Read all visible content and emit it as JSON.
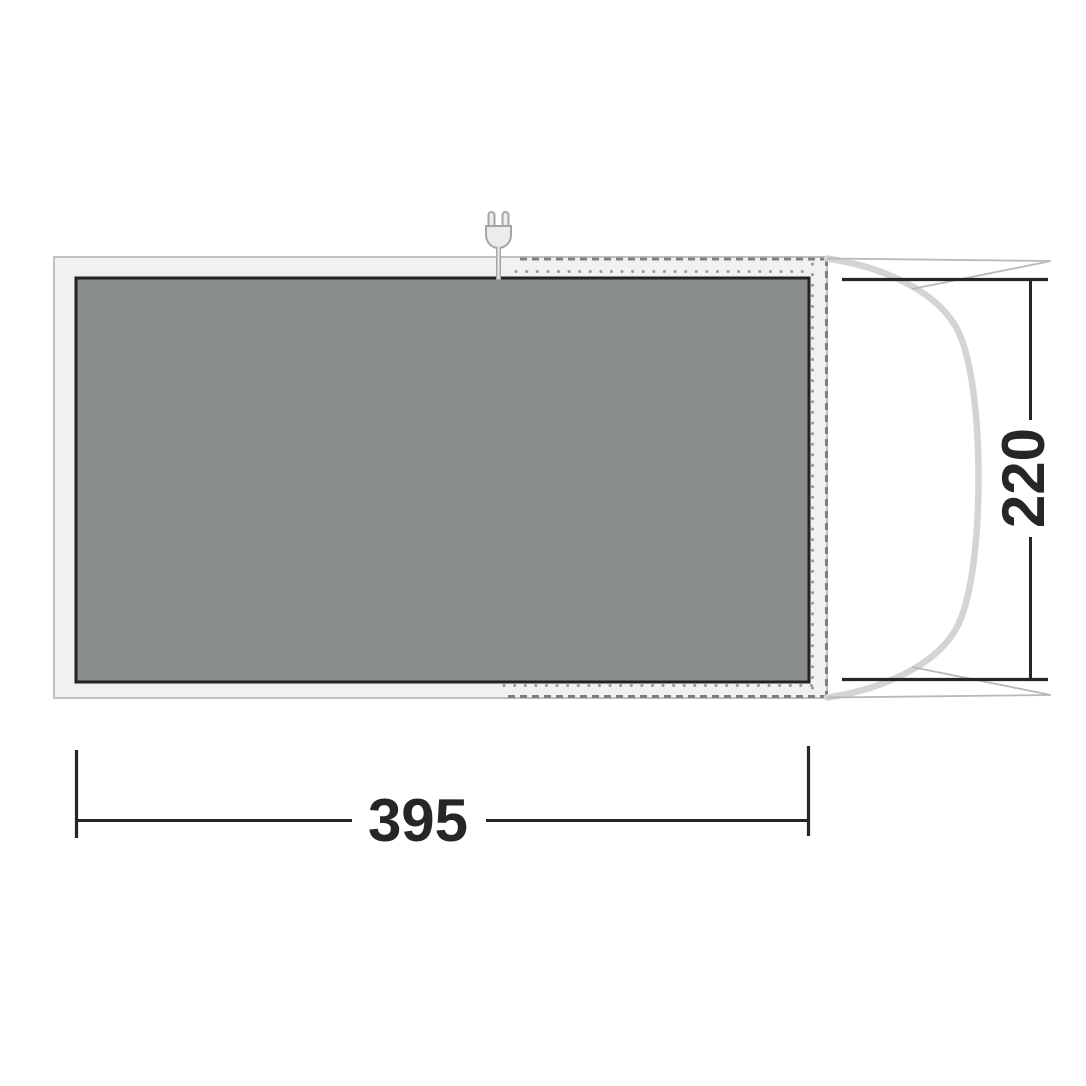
{
  "diagram": {
    "title": "tent-footprint-floorplan",
    "dimensions": {
      "width_label": "395",
      "height_label": "220"
    },
    "icons": [
      "power-plug-icon"
    ],
    "colors": {
      "groundsheet_fill": "#f1f1f1",
      "groundsheet_stroke": "#c0c0c0",
      "floor_fill": "#898d8c",
      "floor_stroke": "#232323",
      "seam_dash": "#7f7f7f",
      "seam_dot": "#9a9a9a",
      "tent_curve": "#d4d4d4",
      "guy_line": "#b9b9b9",
      "dimension": "#262626",
      "plug_fill": "#ececec",
      "plug_stroke": "#a5a5a5"
    }
  }
}
